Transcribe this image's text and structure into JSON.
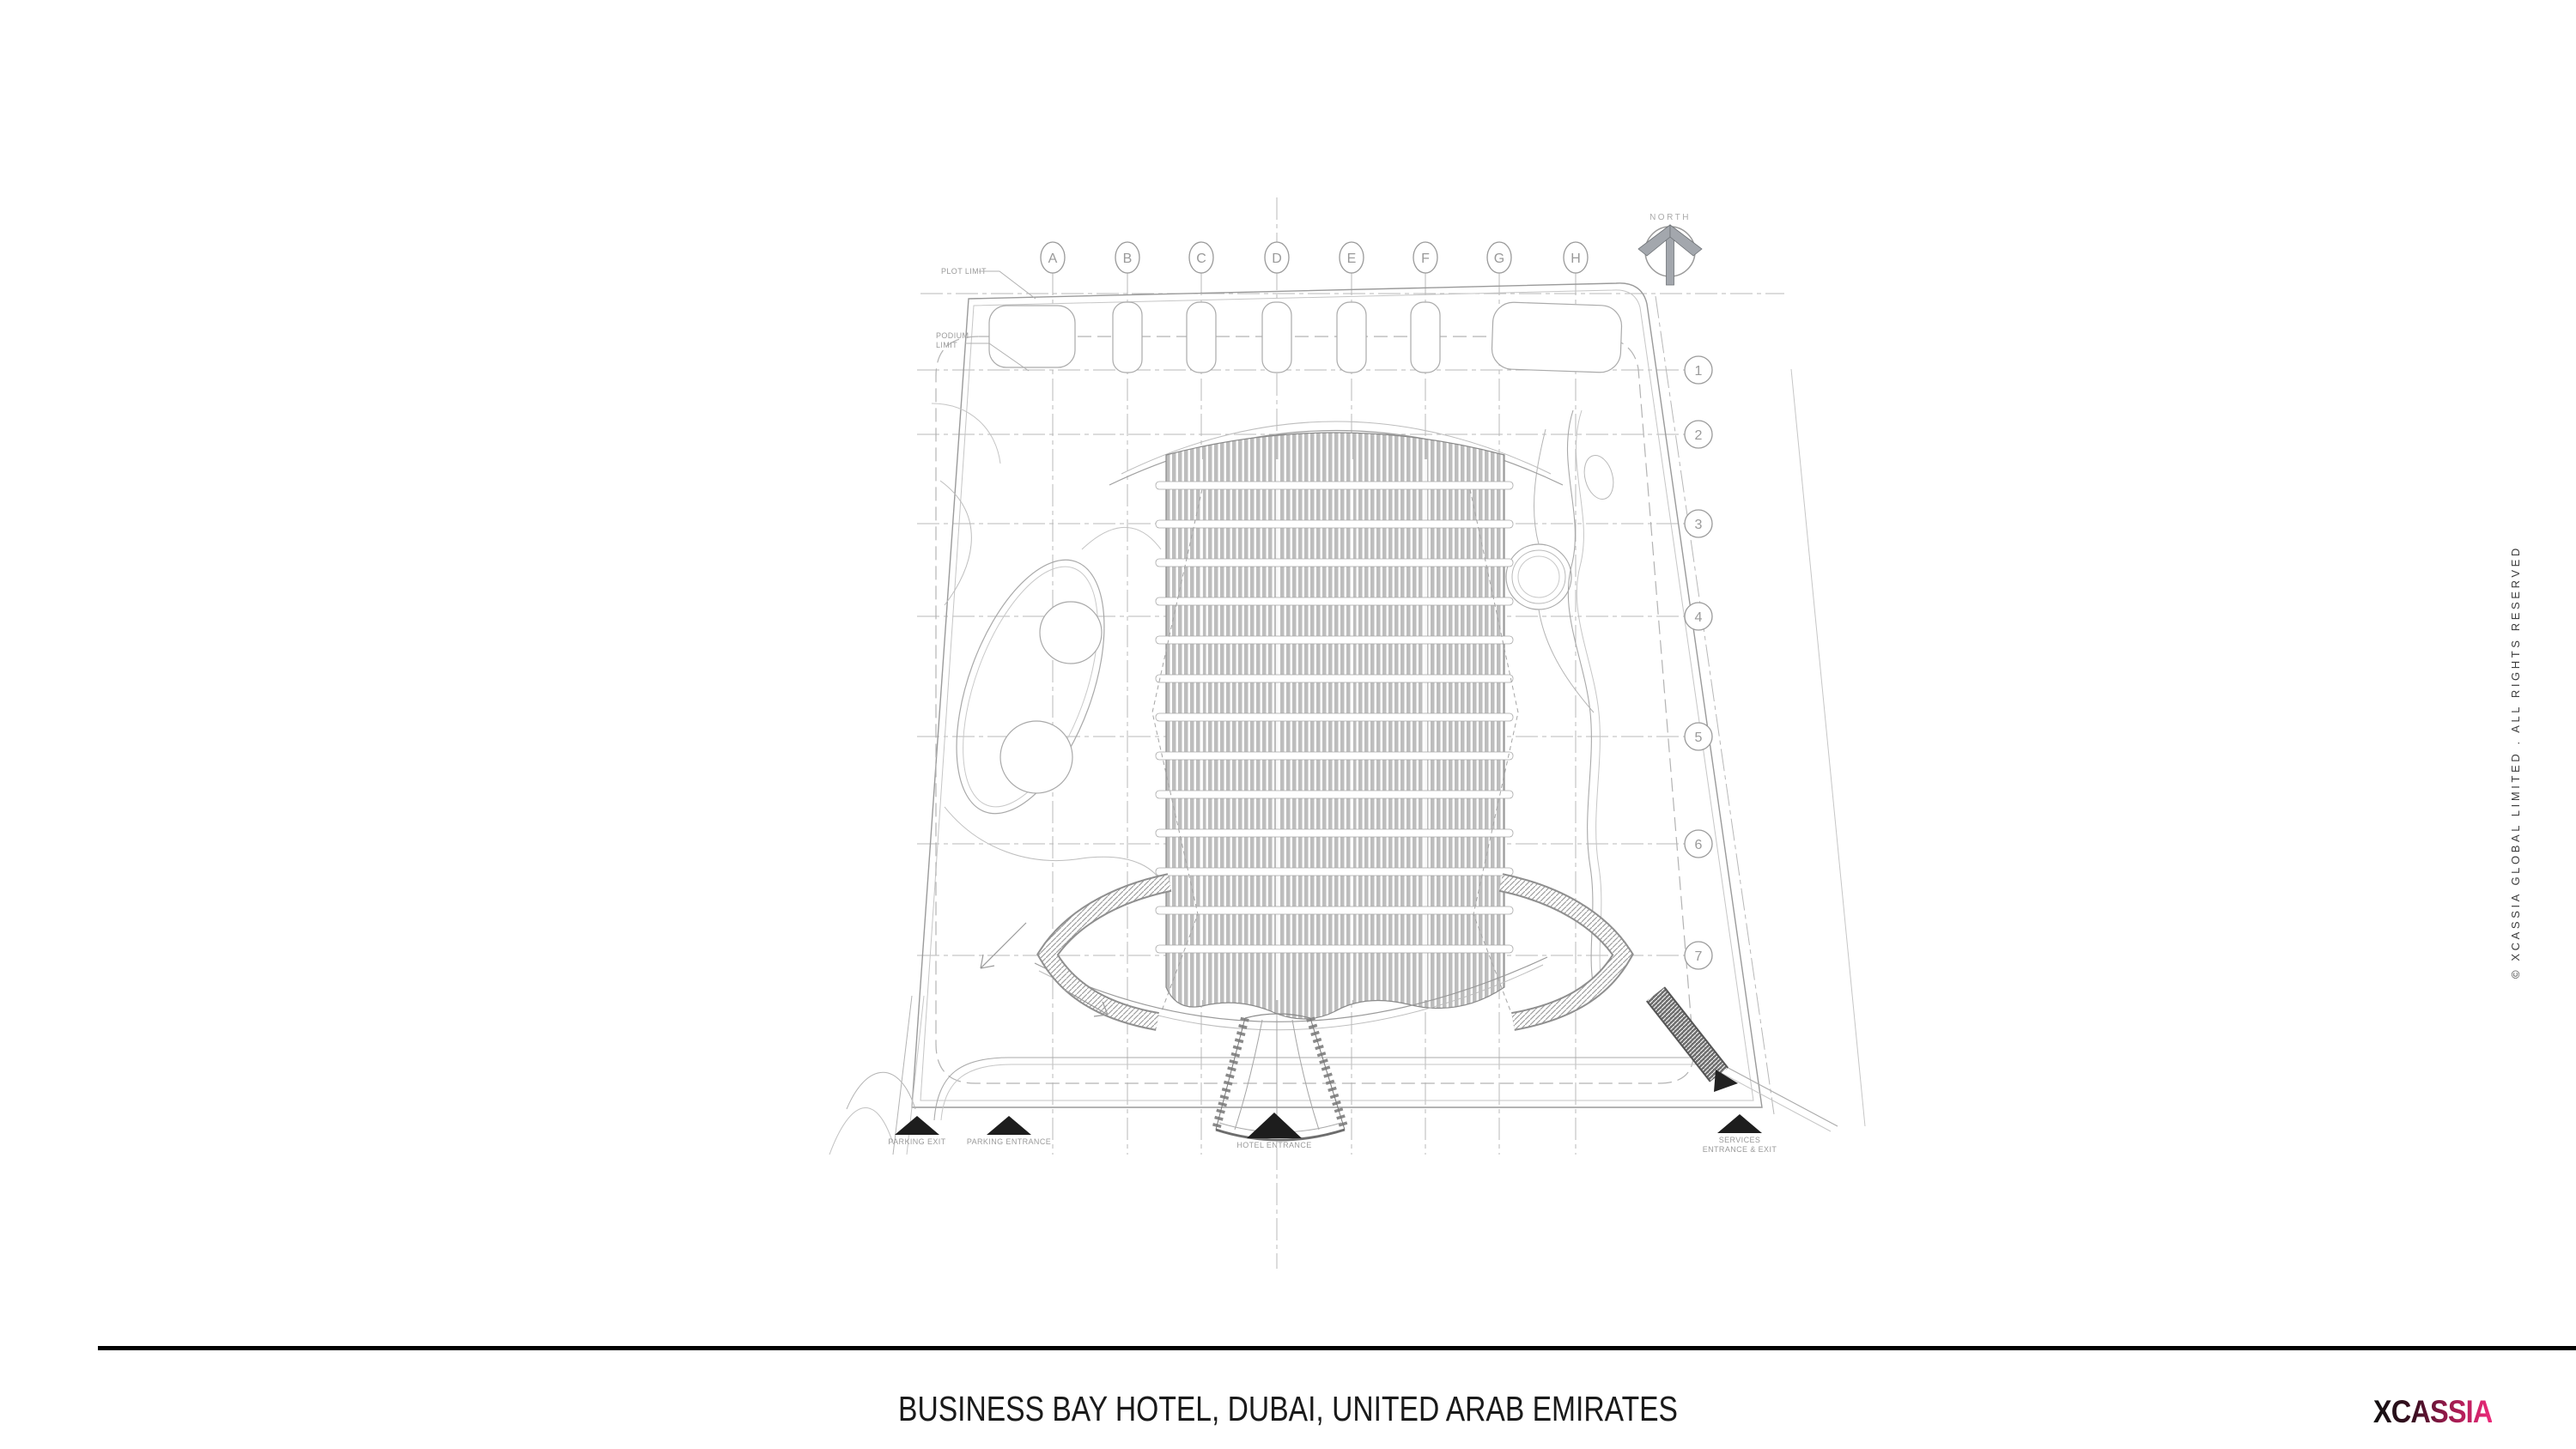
{
  "sheet": {
    "title": "BUSINESS BAY HOTEL, DUBAI, UNITED ARAB EMIRATES",
    "copyright": "© XCASSIA GLOBAL LIMITED . ALL RIGHTS RESERVED",
    "brand": "XCASSIA"
  },
  "drawing": {
    "north_label": "NORTH",
    "grid": {
      "columns": [
        "A",
        "B",
        "C",
        "D",
        "E",
        "F",
        "G",
        "H"
      ],
      "rows": [
        "1",
        "2",
        "3",
        "4",
        "5",
        "6",
        "7"
      ]
    },
    "labels": {
      "plot_limit": "PLOT LIMIT",
      "podium_limit_line1": "PODIUM",
      "podium_limit_line2": "LIMIT",
      "parking_exit": "PARKING EXIT",
      "parking_entrance": "PARKING ENTRANCE",
      "hotel_entrance": "HOTEL ENTRANCE",
      "services_line1": "SERVICES",
      "services_line2": "ENTRANCE & EXIT"
    },
    "colors": {
      "line_gray": "#a0a0a0",
      "light_gray": "#c2c2c2",
      "louver_gray": "#bdbdbd",
      "ink": "#1a1a1a",
      "brand_pink": "#ec2a7a"
    }
  }
}
